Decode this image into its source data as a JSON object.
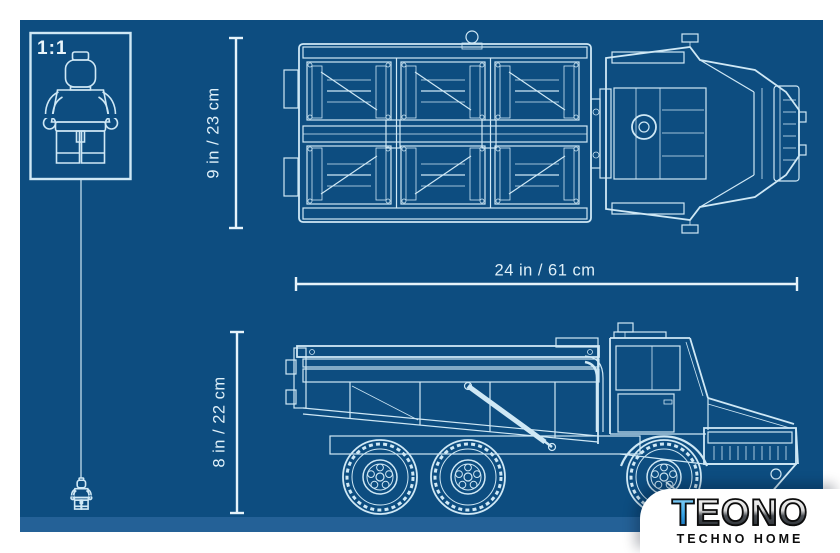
{
  "scale_box": {
    "label": "1:1"
  },
  "dimension_labels": {
    "top_view_height": "9 in / 23 cm",
    "overall_length": "24 in / 61 cm",
    "side_view_height": "8 in / 22 cm"
  },
  "figures": {
    "scale_figure_icon": "lego-minifigure-outline",
    "hanging_figure_icon": "lego-minifigure-outline-small"
  },
  "views": {
    "top": "dump-truck-top-view-blueprint",
    "side": "dump-truck-side-view-blueprint"
  },
  "watermark": {
    "brand_first_letter": "T",
    "brand_rest": "EONO",
    "subtitle": "TECHNO HOME"
  },
  "colors": {
    "blueprint_background": "#0d4d80",
    "blueprint_line": "#cfe8f5",
    "dimension_line": "#e6f3fa",
    "watermark_panel": "#ffffff",
    "brand_accent_blue": "#36a3e6",
    "brand_dark": "#1d2024"
  }
}
